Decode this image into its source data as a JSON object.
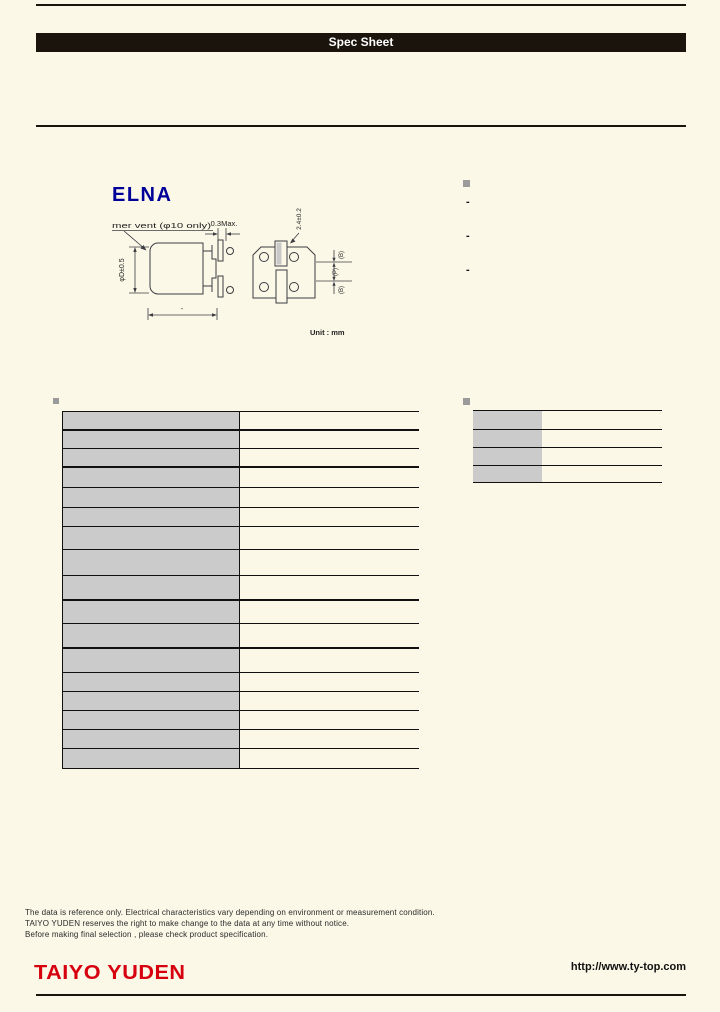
{
  "header": {
    "title": "Spec Sheet"
  },
  "brand": {
    "elna_logo": "ELNA"
  },
  "drawing": {
    "vent_label": "mer vent (φ10 only)",
    "dim_top": "0.3Max.",
    "dim_left": "φD±0.5",
    "dim_bottom": "-",
    "dim_pad_width": "2.4±0.2",
    "dim_b_top": "(B)",
    "dim_p": "(P)",
    "dim_b_bottom": "(B)",
    "unit": "Unit : mm"
  },
  "features": {
    "title": "",
    "marker": "-",
    "items": [
      {
        "text": ""
      },
      {
        "text": ""
      },
      {
        "text": ""
      }
    ]
  },
  "spec_table": {
    "title": "",
    "rows": [
      {
        "label": "",
        "value": ""
      },
      {
        "label": "",
        "value": ""
      },
      {
        "label": "",
        "value": ""
      },
      {
        "label": "",
        "value": ""
      },
      {
        "label": "",
        "value": ""
      },
      {
        "label": "",
        "value": ""
      },
      {
        "label": "",
        "value": ""
      },
      {
        "label": "",
        "value": ""
      },
      {
        "label": "",
        "value": ""
      },
      {
        "label": "",
        "value": ""
      },
      {
        "label": "",
        "value": ""
      },
      {
        "label": "",
        "value": ""
      },
      {
        "label": "",
        "value": ""
      },
      {
        "label": "",
        "value": ""
      },
      {
        "label": "",
        "value": ""
      },
      {
        "label": "",
        "value": ""
      },
      {
        "label": "",
        "value": ""
      }
    ]
  },
  "right_table": {
    "title": "",
    "rows": [
      {
        "label": "",
        "value": ""
      },
      {
        "label": "",
        "value": ""
      },
      {
        "label": "",
        "value": ""
      },
      {
        "label": "",
        "value": ""
      }
    ]
  },
  "footer": {
    "disclaimer": [
      "The data is reference only. Electrical characteristics vary depending on environment or measurement condition.",
      "TAIYO YUDEN reserves the right to make change to the data at any time without notice.",
      "Before making final selection , please check product specification."
    ],
    "logo": "TAIYO YUDEN",
    "url": "http://www.ty-top.com"
  },
  "colors": {
    "background": "#FBF8E7",
    "bar": "#1b140d",
    "table_label_bg": "#cbcbcb",
    "elna_blue": "#000099",
    "taiyo_red": "#D6000F",
    "bullet_gray": "#9b9b9b"
  }
}
